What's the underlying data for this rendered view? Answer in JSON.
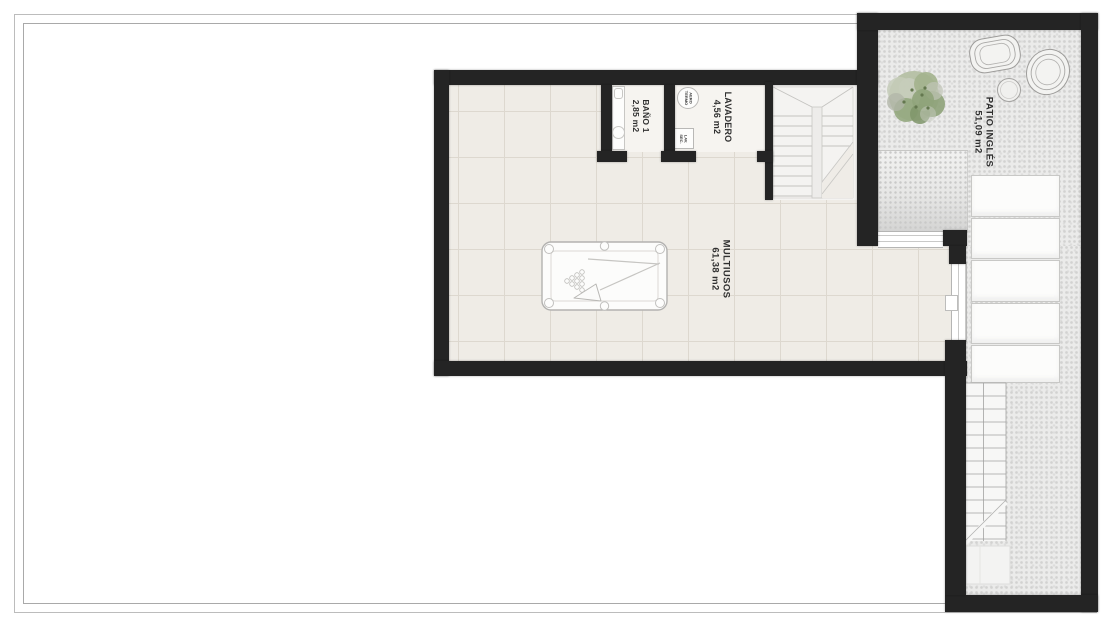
{
  "plan": {
    "rooms": [
      {
        "id": "bano1",
        "name": "BAÑO 1",
        "area": "2,85 m2"
      },
      {
        "id": "lavadero",
        "name": "LAVADERO",
        "area": "4,56 m2"
      },
      {
        "id": "multiusos",
        "name": "MULTIUSOS",
        "area": "61,38 m2"
      },
      {
        "id": "patio_ingles",
        "name": "PATIO INGLÉS",
        "area": "51,09 m2"
      }
    ],
    "equipment": [
      {
        "id": "aerotermo",
        "line1": "AERO",
        "line2": "TERMO"
      },
      {
        "id": "lav_sec",
        "line1": "LAV.",
        "line2": "SEC."
      }
    ],
    "colors": {
      "wall": "#242424",
      "floor_tile": "#efece6",
      "grout": "#ddd8cf",
      "patio_base": "#ebebea",
      "patio_dot": "#d2d2d1",
      "plant_green": "#8ea279",
      "line_gray": "#c4c3c0"
    }
  }
}
